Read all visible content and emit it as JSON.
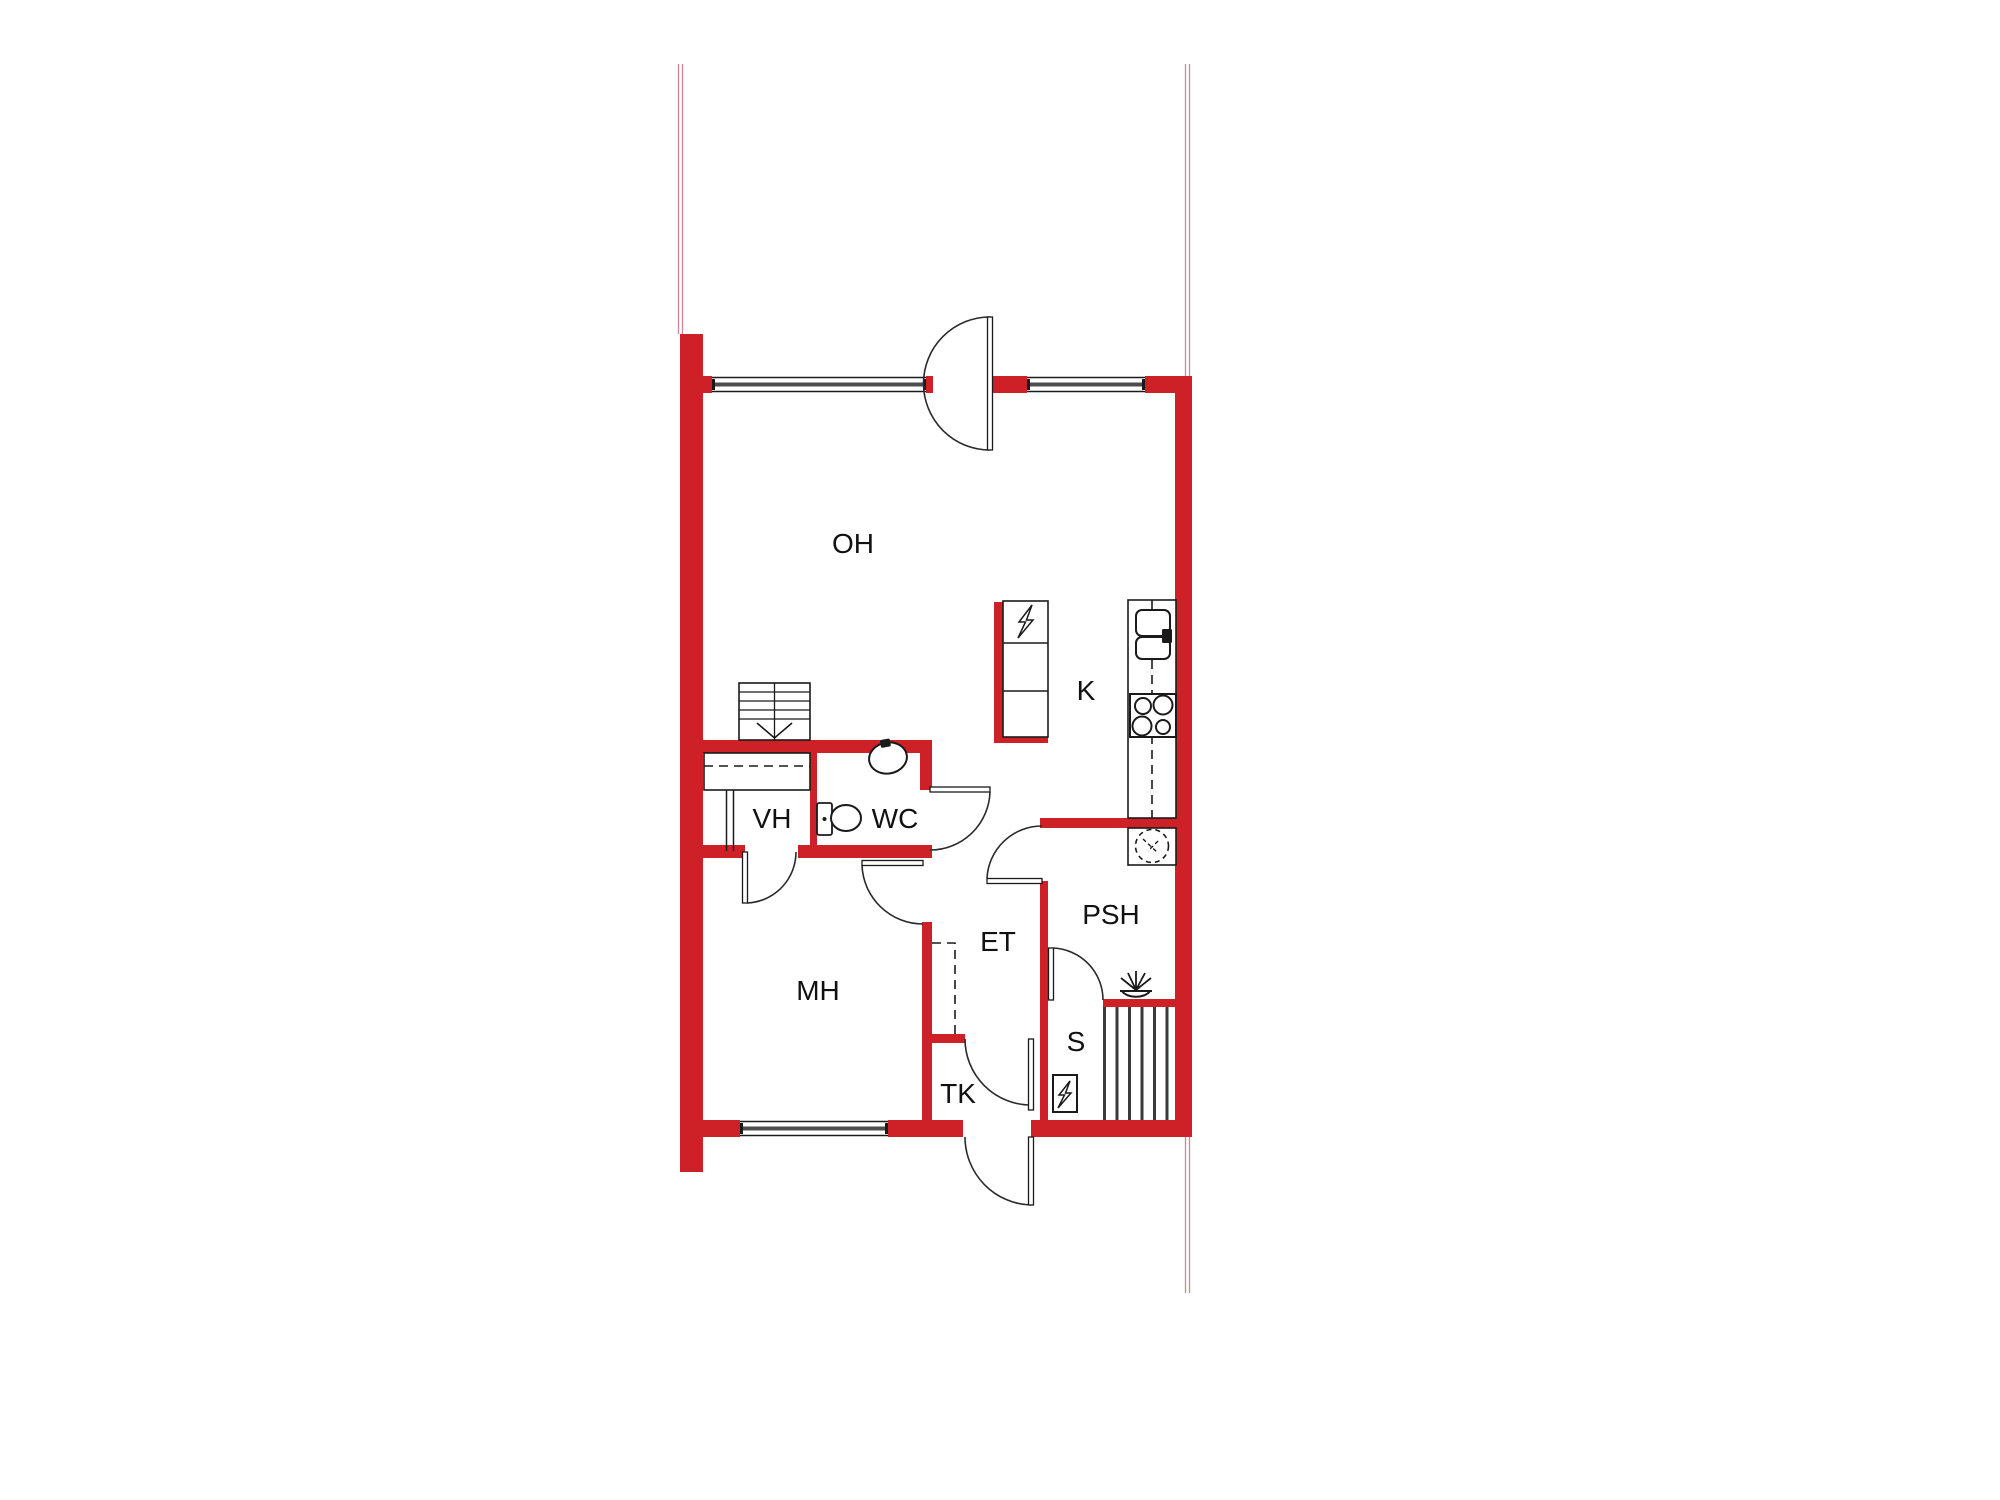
{
  "floorplan": {
    "rooms": [
      {
        "code": "OH",
        "name": "living-room"
      },
      {
        "code": "K",
        "name": "kitchen"
      },
      {
        "code": "VH",
        "name": "walk-in-closet"
      },
      {
        "code": "WC",
        "name": "toilet-room"
      },
      {
        "code": "MH",
        "name": "bedroom"
      },
      {
        "code": "ET",
        "name": "entry-hall"
      },
      {
        "code": "PSH",
        "name": "washroom"
      },
      {
        "code": "S",
        "name": "sauna"
      },
      {
        "code": "TK",
        "name": "vestibule"
      }
    ],
    "symbols": [
      {
        "name": "stairs-icon"
      },
      {
        "name": "wardrobe-icon"
      },
      {
        "name": "wc-sink-icon"
      },
      {
        "name": "toilet-icon"
      },
      {
        "name": "electric-cabinet-icon"
      },
      {
        "name": "kitchen-sink-icon"
      },
      {
        "name": "stove-icon"
      },
      {
        "name": "washing-machine-icon"
      },
      {
        "name": "shower-icon"
      },
      {
        "name": "sauna-heater-icon"
      },
      {
        "name": "sauna-bench-icon"
      }
    ],
    "colors": {
      "wall_red": "#ce2127",
      "outline_black": "#1a1a1a",
      "glazing_gray": "#4d4d4d",
      "boundary_line_pink": "#d4858a",
      "background": "#ffffff"
    }
  }
}
